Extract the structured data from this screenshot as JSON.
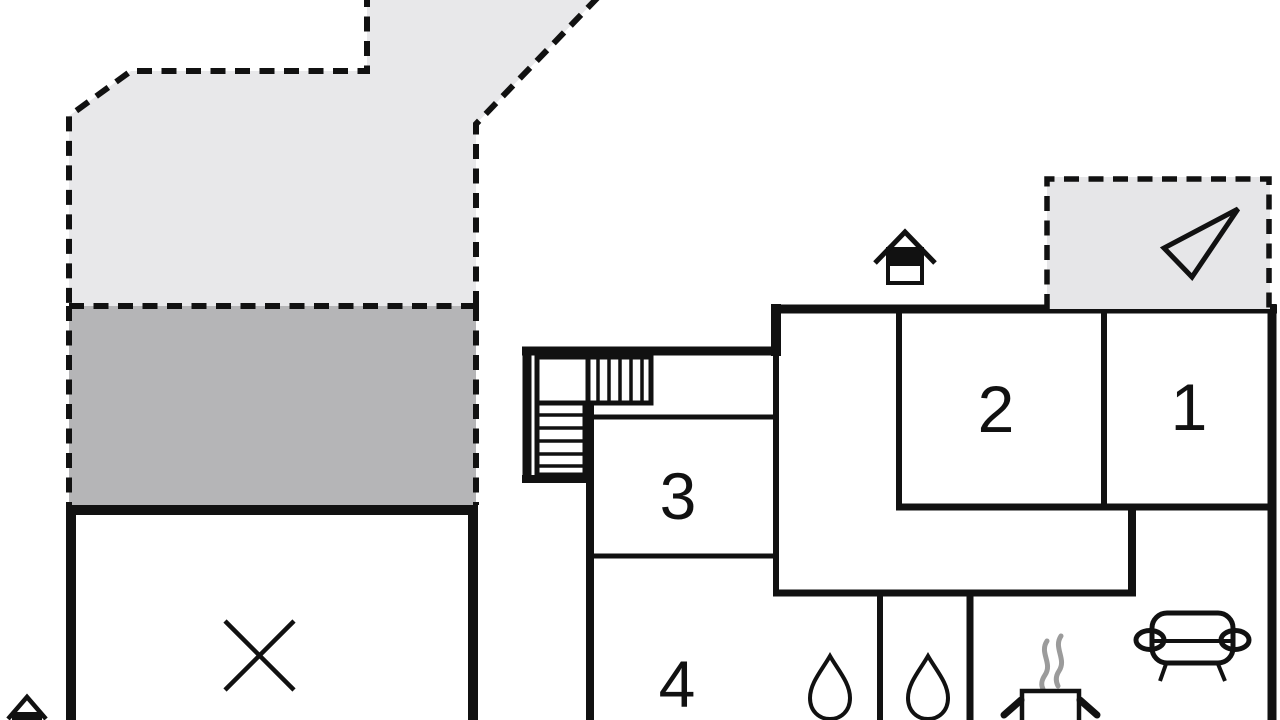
{
  "plan": {
    "type": "floor-plan",
    "rooms": [
      {
        "label": "1"
      },
      {
        "label": "2"
      },
      {
        "label": "3"
      },
      {
        "label": "4"
      }
    ],
    "areas": {
      "upper_terrace": "dashed outdoor area (light grey)",
      "lower_terrace": "dashed outdoor area (dark grey)",
      "carport": "room marked with cross",
      "shower_rooms": "two rooms with water drops",
      "kitchen": "room with cooking pot",
      "living_room": "room with sofa"
    },
    "icons": [
      "house-entrance-icon",
      "north-arrow-icon",
      "staircase-icon",
      "cross-icon",
      "water-drop-icon",
      "cooking-pot-icon",
      "steam-icon",
      "sofa-icon"
    ]
  },
  "colors": {
    "background": "#ffffff",
    "wall": "#111111",
    "terrace_light": "#e8e8ea",
    "terrace_dark": "#b5b5b7",
    "north_box": "#e6e6e8",
    "water_drop": "#b6eef5",
    "steam": "#9b9b9b",
    "icon_black": "#111111",
    "label": "#111111"
  }
}
